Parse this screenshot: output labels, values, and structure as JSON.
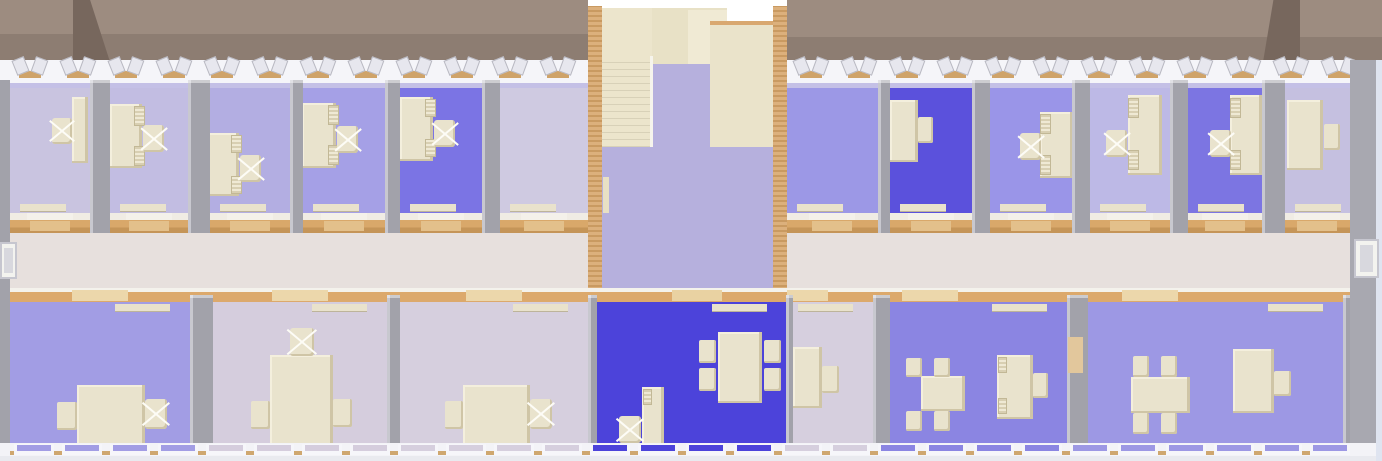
{
  "scene": {
    "width": 1382,
    "height": 461,
    "description": "overhead 3D cutaway render of an office building floor: two office wings, central stairwell lobby, corridor, furnished rooms"
  },
  "palette": {
    "roof_upper": "#9d8c80",
    "roof_lower": "#8d7d72",
    "roof_dark": "#77675d",
    "roof_right_ext": "#a09083",
    "wall": "#a2a2aa",
    "wall_edge": "#c8c8cf",
    "end_wall": "#a8a8b0",
    "edge_strip": "#dfe4f0",
    "band_white": "#f5f5f9",
    "band_lavender": "#c4c0e6",
    "corridor_floor": "#e7e0dd",
    "lobby_floor": "#b6b0dd",
    "stair_cream": "#ece5cc",
    "landing": "#e8e1c6",
    "landing_light": "#f0ead4",
    "flight": "#eae3ca",
    "flight_edge": "#d9a870",
    "furniture": "#e9e3cd",
    "furniture_shadow": "#cfc5a6",
    "tan_bar": "#cfa369",
    "door_sill": "#f4f1ea",
    "door_top": "#e3c08b",
    "door_bottom": "#ecd7ab",
    "lobby_door_gap": "#e9d2a2",
    "sill_white": "#f6f6fa",
    "bottom_tan_line": "#cfa76f",
    "bottom_strip": "#e9eaef",
    "wall_gap_sill": "#d9d9e2"
  },
  "rects": {
    "roof": [
      {
        "n": "roof-left-upper-slope",
        "x": 0,
        "y": 0,
        "w": 588,
        "h": 34,
        "c": "#9d8c80"
      },
      {
        "n": "roof-left-lower-slope",
        "x": 0,
        "y": 34,
        "w": 588,
        "h": 31,
        "c": "#8d7d72"
      },
      {
        "n": "roof-right-upper-slope",
        "x": 787,
        "y": 0,
        "w": 595,
        "h": 37,
        "c": "#9d8c80"
      },
      {
        "n": "roof-right-lower-slope",
        "x": 787,
        "y": 37,
        "w": 595,
        "h": 31,
        "c": "#8d7d72"
      },
      {
        "n": "roof-right-end-slope",
        "x": 1300,
        "y": 60,
        "w": 82,
        "h": 13,
        "c": "#a09083"
      },
      {
        "n": "roof-hip-shadow-left",
        "x": 73,
        "y": 0,
        "w": 38,
        "h": 65,
        "c": "#77675d",
        "clip": "polygon(0 0,45% 0,100% 100%,0 100%)"
      },
      {
        "n": "roof-hip-shadow-right",
        "x": 1262,
        "y": 0,
        "w": 38,
        "h": 68,
        "c": "#77675d",
        "clip": "polygon(30% 0,100% 0,100% 100%,0 100%)"
      }
    ],
    "bands": [
      {
        "n": "north-facade-band",
        "x": 0,
        "y": 60,
        "w": 1382,
        "h": 28,
        "c": "#f5f5f9"
      },
      {
        "n": "north-wall-lavender-line-left",
        "x": 10,
        "y": 83,
        "w": 578,
        "h": 5,
        "c": "#c4c0e6"
      },
      {
        "n": "north-wall-lavender-line-right",
        "x": 787,
        "y": 83,
        "w": 563,
        "h": 5,
        "c": "#c4c0e6"
      }
    ],
    "corridor": [
      {
        "n": "corridor-floor-left",
        "x": 10,
        "y": 225,
        "w": 578,
        "h": 68,
        "c": "#e7e0dd"
      },
      {
        "n": "corridor-floor-right",
        "x": 787,
        "y": 225,
        "w": 563,
        "h": 68,
        "c": "#e7e0dd"
      },
      {
        "n": "corridor-north-wall-left",
        "x": 10,
        "y": 213,
        "w": 578,
        "h": 20,
        "cls": "corridor-band-top"
      },
      {
        "n": "corridor-north-wall-right",
        "x": 787,
        "y": 213,
        "w": 563,
        "h": 20,
        "cls": "corridor-band-top"
      },
      {
        "n": "corridor-south-wall",
        "x": 10,
        "y": 288,
        "w": 1340,
        "h": 14,
        "cls": "corridor-band-bottom"
      }
    ],
    "stairwell": [
      {
        "n": "stairwell-background",
        "x": 588,
        "y": 0,
        "w": 199,
        "h": 295,
        "c": "#ffffff"
      },
      {
        "n": "stairwell-west-wall",
        "x": 588,
        "y": 6,
        "w": 14,
        "h": 289,
        "cls": "tanwall"
      },
      {
        "n": "stairwell-east-wall",
        "x": 773,
        "y": 6,
        "w": 14,
        "h": 289,
        "cls": "tanwall"
      },
      {
        "n": "stair-upper-flight",
        "x": 602,
        "y": 8,
        "w": 50,
        "h": 48,
        "c": "#ece5cc"
      },
      {
        "n": "stair-steps",
        "x": 602,
        "y": 56,
        "w": 50,
        "h": 91,
        "cls": "stairs-striped"
      },
      {
        "n": "stair-landing",
        "x": 652,
        "y": 8,
        "w": 75,
        "h": 56,
        "c": "#e8e1c6"
      },
      {
        "n": "stair-landing-highlight",
        "x": 688,
        "y": 10,
        "w": 39,
        "h": 54,
        "c": "#f0ead4"
      },
      {
        "n": "stair-right-flight-edge",
        "x": 710,
        "y": 21,
        "w": 63,
        "h": 4,
        "c": "#d9a870"
      },
      {
        "n": "stair-right-flight",
        "x": 710,
        "y": 25,
        "w": 63,
        "h": 123,
        "c": "#eae3ca"
      },
      {
        "n": "stairwell-opening-floor",
        "x": 652,
        "y": 64,
        "w": 58,
        "h": 84,
        "c": "#b6b0dd"
      },
      {
        "n": "stair-side-edge",
        "x": 650,
        "y": 56,
        "w": 3,
        "h": 92,
        "c": "#f6f4ec"
      },
      {
        "n": "lobby-floor",
        "x": 602,
        "y": 147,
        "w": 171,
        "h": 148,
        "c": "#b6b0dd"
      },
      {
        "n": "lobby-side-door",
        "x": 603,
        "y": 177,
        "w": 6,
        "h": 36,
        "c": "#e8e0c4"
      }
    ],
    "overlays": [
      {
        "n": "corridor-south-wall-center",
        "x": 588,
        "y": 288,
        "w": 199,
        "h": 14,
        "cls": "corridor-band-bottom"
      },
      {
        "n": "lobby-door-gap",
        "x": 672,
        "y": 290,
        "w": 50,
        "h": 11,
        "c": "#e9d2a2"
      },
      {
        "n": "open-door-panel",
        "x": 1068,
        "y": 337,
        "w": 15,
        "h": 36,
        "c": "#e2c79c"
      },
      {
        "n": "west-end-wall",
        "x": 0,
        "y": 80,
        "w": 10,
        "h": 363,
        "c": "#a2a2aa"
      },
      {
        "n": "east-end-wall",
        "x": 1350,
        "y": 60,
        "w": 26,
        "h": 383,
        "c": "#a8a8b0"
      },
      {
        "n": "east-edge-strip",
        "x": 1376,
        "y": 60,
        "w": 6,
        "h": 401,
        "c": "#dfe4f0"
      },
      {
        "n": "west-entrance-door",
        "x": 0,
        "y": 242,
        "w": 17,
        "h": 37,
        "cls": "door-frame"
      },
      {
        "n": "west-entrance-door-leaf",
        "x": 4,
        "y": 248,
        "w": 9,
        "h": 25,
        "c": "#d8d8de"
      },
      {
        "n": "east-entrance-door",
        "x": 1354,
        "y": 239,
        "w": 25,
        "h": 39,
        "cls": "door-frame"
      },
      {
        "n": "east-entrance-door-leaf",
        "x": 1360,
        "y": 245,
        "w": 13,
        "h": 27,
        "c": "#d8d8de"
      }
    ],
    "bottom_band": [
      {
        "n": "south-facade-band",
        "x": 0,
        "y": 443,
        "w": 1382,
        "h": 13,
        "c": "#f3f3f7"
      },
      {
        "n": "south-facade-tan-line",
        "x": 10,
        "y": 451,
        "w": 1340,
        "h": 4,
        "c": "#cfa76f"
      },
      {
        "n": "south-facade-bottom-strip",
        "x": 0,
        "y": 456,
        "w": 1382,
        "h": 5,
        "c": "#e9eaef"
      }
    ]
  },
  "top_room_geom": {
    "floor_y": 88,
    "floor_h": 125,
    "door_bar_y": 204
  },
  "bottom_room_geom": {
    "floor_y": 302,
    "floor_h": 141,
    "door_bar_y": 304
  },
  "top_rooms": [
    {
      "id": "A1",
      "x": 10,
      "w": 80,
      "floor": "#c9c4e0",
      "furniture": [
        [
          "desk",
          72,
          97,
          16,
          66
        ],
        [
          "swivel",
          52,
          118,
          20,
          26
        ]
      ]
    },
    {
      "id": "A2",
      "x": 110,
      "w": 78,
      "floor": "#c2bde2",
      "furniture": [
        [
          "desk",
          110,
          104,
          32,
          64
        ],
        [
          "shelf",
          134,
          106,
          11,
          20
        ],
        [
          "shelf",
          134,
          146,
          11,
          20
        ],
        [
          "swivel",
          143,
          125,
          21,
          27
        ]
      ]
    },
    {
      "id": "A3",
      "x": 210,
      "w": 80,
      "floor": "#b3aee2",
      "furniture": [
        [
          "desk",
          206,
          133,
          33,
          63
        ],
        [
          "shelf",
          231,
          135,
          11,
          18
        ],
        [
          "shelf",
          231,
          176,
          11,
          18
        ],
        [
          "swivel",
          240,
          155,
          21,
          27
        ]
      ]
    },
    {
      "id": "A4",
      "x": 303,
      "w": 82,
      "floor": "#a5a0e6",
      "furniture": [
        [
          "desk",
          302,
          103,
          34,
          65
        ],
        [
          "shelf",
          328,
          105,
          11,
          20
        ],
        [
          "shelf",
          328,
          145,
          11,
          20
        ],
        [
          "swivel",
          337,
          126,
          21,
          27
        ]
      ]
    },
    {
      "id": "A5",
      "x": 400,
      "w": 82,
      "floor": "#7b74e4",
      "furniture": [
        [
          "desk",
          400,
          97,
          33,
          64
        ],
        [
          "shelf",
          425,
          99,
          11,
          18
        ],
        [
          "shelf",
          425,
          139,
          11,
          18
        ],
        [
          "swivel",
          434,
          120,
          21,
          27
        ]
      ]
    },
    {
      "id": "A6",
      "x": 500,
      "w": 88,
      "floor": "#cfcae1",
      "furniture": []
    },
    {
      "id": "A7",
      "x": 787,
      "w": 91,
      "floor": "#9c98e6",
      "furniture": []
    },
    {
      "id": "A8",
      "x": 890,
      "w": 82,
      "floor": "#5b51dc",
      "furniture": [
        [
          "desk",
          890,
          100,
          28,
          62
        ],
        [
          "chair",
          918,
          117,
          15,
          26
        ]
      ]
    },
    {
      "id": "A9",
      "x": 990,
      "w": 82,
      "floor": "#9a95e8",
      "furniture": [
        [
          "desk",
          1040,
          112,
          33,
          66
        ],
        [
          "shelf",
          1040,
          114,
          11,
          20
        ],
        [
          "shelf",
          1040,
          155,
          11,
          20
        ],
        [
          "swivel",
          1020,
          133,
          21,
          27
        ]
      ]
    },
    {
      "id": "A10",
      "x": 1090,
      "w": 80,
      "floor": "#bdb9e6",
      "furniture": [
        [
          "desk",
          1128,
          95,
          34,
          80
        ],
        [
          "shelf",
          1128,
          98,
          11,
          20
        ],
        [
          "shelf",
          1128,
          150,
          11,
          20
        ],
        [
          "swivel",
          1106,
          130,
          21,
          27
        ]
      ]
    },
    {
      "id": "A11",
      "x": 1188,
      "w": 74,
      "floor": "#7c75e2",
      "furniture": [
        [
          "desk",
          1230,
          95,
          32,
          80
        ],
        [
          "shelf",
          1230,
          98,
          11,
          20
        ],
        [
          "shelf",
          1230,
          150,
          11,
          20
        ],
        [
          "swivel",
          1210,
          130,
          21,
          27
        ]
      ]
    },
    {
      "id": "A12",
      "x": 1285,
      "w": 65,
      "floor": "#c5c0e0",
      "furniture": [
        [
          "desk",
          1287,
          100,
          36,
          70
        ],
        [
          "chair",
          1324,
          124,
          16,
          26
        ]
      ]
    }
  ],
  "bottom_rooms": [
    {
      "id": "B1",
      "x": 10,
      "w": 180,
      "floor": "#a29de4",
      "furniture": [
        [
          "table",
          77,
          385,
          68,
          60
        ],
        [
          "chair",
          57,
          402,
          20,
          28
        ],
        [
          "swivel",
          145,
          399,
          22,
          30
        ]
      ]
    },
    {
      "id": "B2",
      "x": 213,
      "w": 174,
      "floor": "#d5cddd",
      "furniture": [
        [
          "table",
          270,
          355,
          63,
          94
        ],
        [
          "swivel",
          290,
          328,
          24,
          28
        ],
        [
          "chair",
          251,
          401,
          19,
          28
        ],
        [
          "chair",
          333,
          399,
          19,
          28
        ]
      ]
    },
    {
      "id": "B3",
      "x": 400,
      "w": 188,
      "floor": "#d6cfde",
      "furniture": [
        [
          "table",
          463,
          385,
          67,
          60
        ],
        [
          "chair",
          445,
          401,
          18,
          28
        ],
        [
          "swivel",
          530,
          399,
          22,
          30
        ]
      ]
    },
    {
      "id": "B4",
      "x": 597,
      "w": 190,
      "floor": "#4c43da",
      "furniture": [
        [
          "table",
          718,
          332,
          44,
          71
        ],
        [
          "chair",
          699,
          340,
          17,
          23
        ],
        [
          "chair",
          699,
          368,
          17,
          23
        ],
        [
          "chair",
          764,
          340,
          17,
          23
        ],
        [
          "chair",
          764,
          368,
          17,
          23
        ],
        [
          "desk",
          642,
          387,
          22,
          62
        ],
        [
          "shelf",
          643,
          389,
          9,
          16
        ],
        [
          "swivel",
          619,
          416,
          22,
          27
        ]
      ]
    },
    {
      "id": "B5",
      "x": 793,
      "w": 80,
      "floor": "#d6cfde",
      "furniture": [
        [
          "desk",
          793,
          347,
          29,
          61
        ],
        [
          "chair",
          822,
          366,
          17,
          27
        ]
      ]
    },
    {
      "id": "B6",
      "x": 890,
      "w": 177,
      "floor": "#8b85e2",
      "furniture": [
        [
          "table",
          921,
          376,
          44,
          35
        ],
        [
          "chair",
          906,
          358,
          16,
          19
        ],
        [
          "chair",
          934,
          358,
          16,
          19
        ],
        [
          "chair",
          906,
          411,
          16,
          20
        ],
        [
          "chair",
          934,
          411,
          16,
          20
        ],
        [
          "desk",
          997,
          355,
          36,
          64
        ],
        [
          "shelf",
          998,
          357,
          9,
          16
        ],
        [
          "shelf",
          998,
          398,
          9,
          16
        ],
        [
          "chair",
          1033,
          373,
          15,
          25
        ]
      ]
    },
    {
      "id": "B7",
      "x": 1088,
      "w": 255,
      "floor": "#9d98e4",
      "furniture": [
        [
          "table",
          1131,
          377,
          59,
          36
        ],
        [
          "chair",
          1133,
          356,
          16,
          21
        ],
        [
          "chair",
          1161,
          356,
          16,
          21
        ],
        [
          "chair",
          1133,
          413,
          16,
          21
        ],
        [
          "chair",
          1161,
          413,
          16,
          21
        ],
        [
          "desk",
          1233,
          349,
          41,
          64
        ],
        [
          "chair",
          1274,
          371,
          17,
          25
        ]
      ]
    }
  ],
  "walls": {
    "top": {
      "y": 80,
      "h": 153,
      "spans": [
        [
          90,
          20
        ],
        [
          188,
          22
        ],
        [
          290,
          13
        ],
        [
          385,
          15
        ],
        [
          482,
          18
        ],
        [
          878,
          12
        ],
        [
          972,
          18
        ],
        [
          1072,
          18
        ],
        [
          1170,
          18
        ],
        [
          1262,
          23
        ]
      ]
    },
    "bottom": {
      "y": 295,
      "h": 148,
      "spans": [
        [
          190,
          23
        ],
        [
          387,
          13
        ],
        [
          588,
          9
        ],
        [
          786,
          7
        ],
        [
          873,
          17
        ],
        [
          1067,
          21
        ],
        [
          1343,
          7
        ]
      ]
    }
  },
  "doors": {
    "top_centers": [
      50,
      149,
      250,
      344,
      441,
      544,
      832,
      931,
      1031,
      1130,
      1225,
      1317
    ],
    "bottom_centers": [
      100,
      300,
      494,
      800,
      930,
      1150
    ]
  },
  "windows": {
    "top_rows": [
      {
        "start": 14,
        "count": 12,
        "step": 48,
        "y": 58
      },
      {
        "start": 795,
        "count": 12,
        "step": 48,
        "y": 58
      }
    ],
    "bottom_row": {
      "start": 14,
      "count": 28,
      "step": 48,
      "y": 444
    }
  }
}
